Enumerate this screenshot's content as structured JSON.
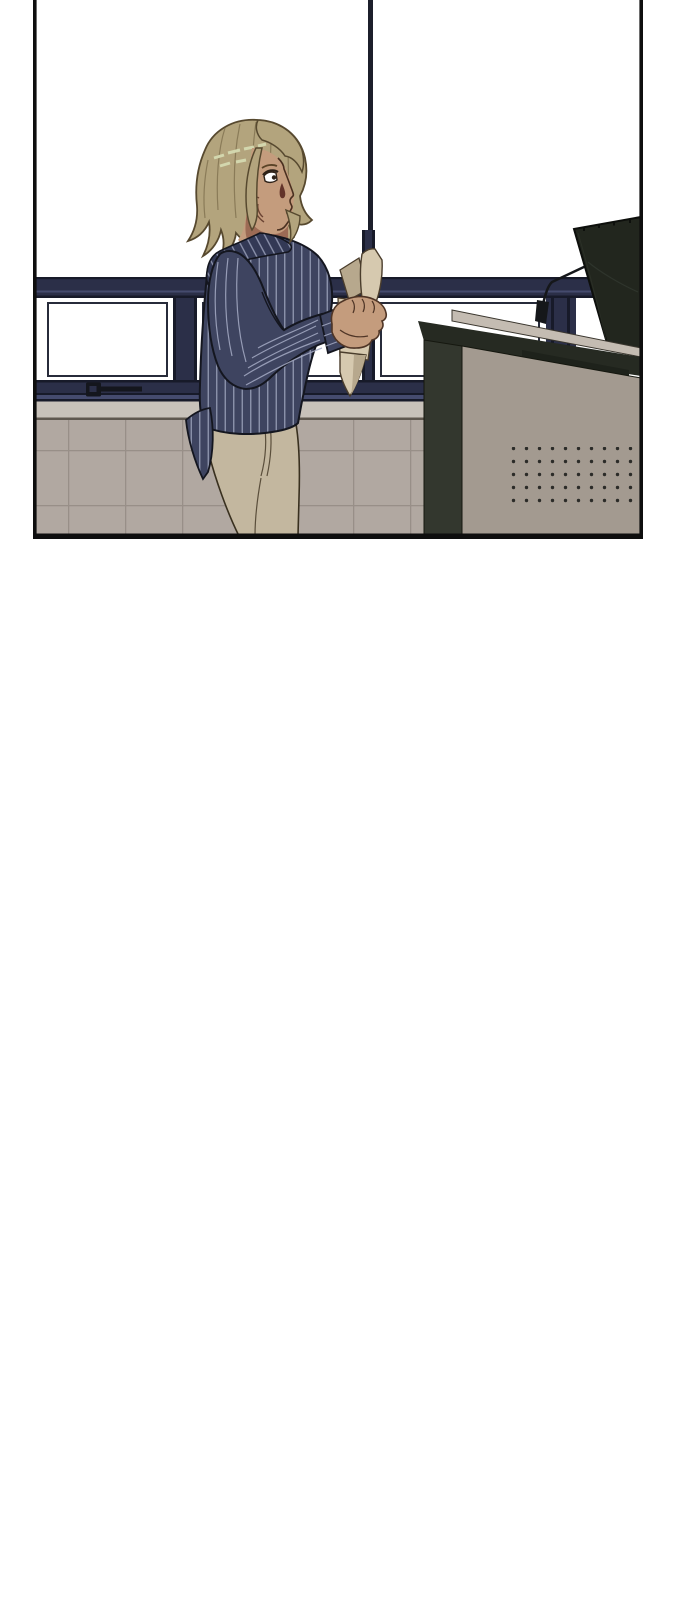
{
  "scene": {
    "medium": "webtoon comic panel, no dialogue text",
    "setting": "classroom interior with a ribbon of navy-framed windows, tiled lower wall, and a lectern podium at right",
    "character": "young woman with chin-length ash-blonde bob seen in right-facing profile, sweat drop on cheek, off-shoulder navy pinstripe jacket, beige trousers, holding a rolled sheaf of papers in her raised right hand",
    "objects": [
      "window top transom bar",
      "tall vertical window divider",
      "three white window panes with inner frames",
      "window latch handle on left pane",
      "window sill ledge",
      "tiled lower wall",
      "podium desk with dark top edge and recessed tray",
      "speaker grille of small dots on desk front",
      "computer monitor seen from behind, tilted",
      "gooseneck microphone"
    ],
    "speaker_grille": {
      "rows": 5,
      "cols": 11
    },
    "panel": {
      "left": 33,
      "top": 0,
      "right": 643,
      "bottom": 539
    },
    "canvas": {
      "width": 690,
      "height": 1600
    }
  },
  "colors": {
    "wall": "#ffffff",
    "panel_border": "#0e0e0e",
    "window_frame": "#2b2f48",
    "window_frame_dark": "#171a29",
    "window_frame_light": "#454b6e",
    "divider_upper": "#1c1f2b",
    "pane": "#ffffff",
    "pane_line": "#272b3a",
    "latch": "#14161d",
    "sill": "#c8c2ba",
    "sill_shadow": "#5f584f",
    "tile": "#b1a8a1",
    "tile_grout": "#988f88",
    "hair": "#b3a47d",
    "hair_strand": "#8a7b58",
    "hair_outline": "#57492f",
    "hair_highlight": "#d3d7ae",
    "skin": "#c49c7d",
    "skin_shadow": "#a87c61",
    "neck_shadow": "#925f4b",
    "sweat": "#63332a",
    "face_line": "#4a3020",
    "jacket": "#3e4460",
    "jacket_shadow": "#333955",
    "jacket_outline": "#14161f",
    "pinstripe": "#a6acc5",
    "trousers": "#c3b79f",
    "trouser_outline": "#39301f",
    "trouser_seam": "#5a4e3b",
    "paper": "#d6c9af",
    "paper_shadow": "#b7a88d",
    "paper_outline": "#4a3d2c",
    "desk_top": "#c4bcb2",
    "desk_edge": "#262a22",
    "desk_tray": "#1e221b",
    "desk_side": "#33372e",
    "desk_front": "#a39a90",
    "speaker_dot": "#2b2b28",
    "monitor": "#22261e",
    "mic": "#15171a"
  }
}
